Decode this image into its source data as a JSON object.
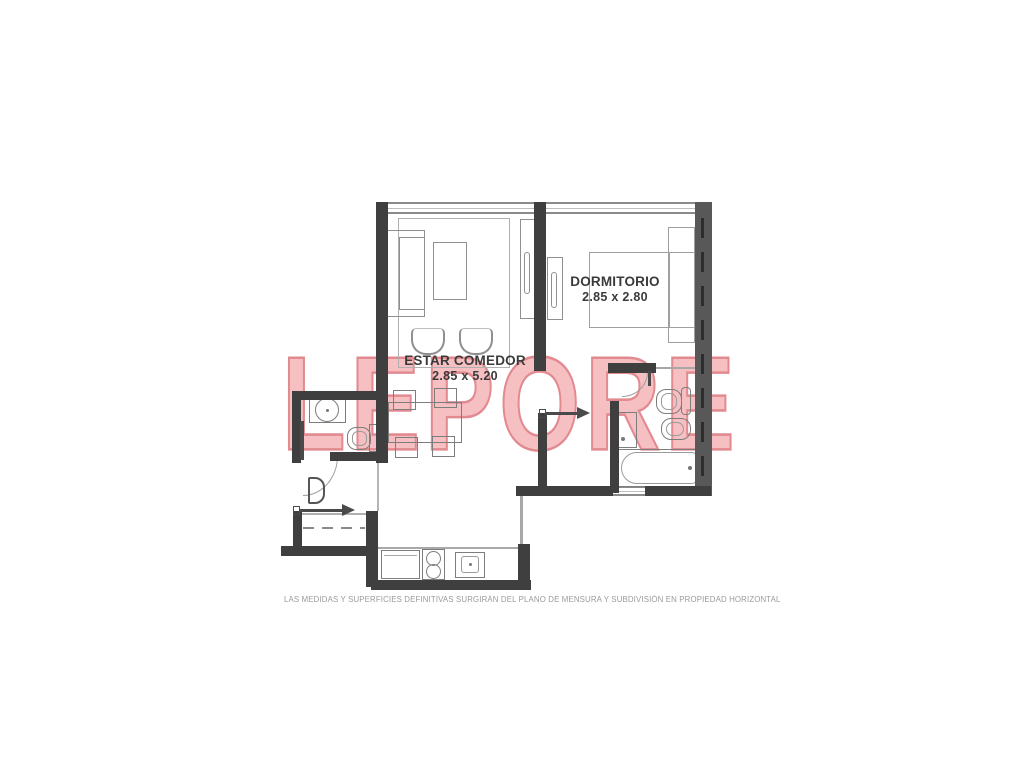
{
  "plan": {
    "watermark": "LEPORE",
    "rooms": [
      {
        "name": "ESTAR COMEDOR",
        "dimensions": "2.85 x 5.20"
      },
      {
        "name": "DORMITORIO",
        "dimensions": "2.85 x 2.80"
      }
    ],
    "entry_marker": "D",
    "disclaimer": "LAS MEDIDAS Y SUPERFICIES DEFINITIVAS SURGIRÁN DEL PLANO DE MENSURA Y SUBDIVISIÓN EN PROPIEDAD HORIZONTAL",
    "colors": {
      "wall": "#3f3f3f",
      "wall_shaded": "#585858",
      "furniture_line": "#8f8f8f",
      "light_line": "#b0b0b0",
      "watermark_fill": "#f6c0c3",
      "watermark_outline": "#e28a90",
      "label_text": "#3a3a3a",
      "disclaimer_text": "#9a9a9a"
    },
    "symbols": {
      "entry_arrow": "entry-direction-arrow",
      "bedroom_arrow": "hall-direction-arrow",
      "door_swing": "quarter-arc-door-swing",
      "fixtures": [
        "sofa",
        "coffee-table",
        "rug",
        "tv-unit",
        "dining-table",
        "dining-chairs",
        "lounge-chairs",
        "bed",
        "headboard",
        "dresser",
        "wc-sink",
        "wc-toilet",
        "bath-toilet",
        "bidet",
        "vanity",
        "bathtub",
        "fridge",
        "stove",
        "kitchen-sink",
        "closet"
      ]
    }
  }
}
